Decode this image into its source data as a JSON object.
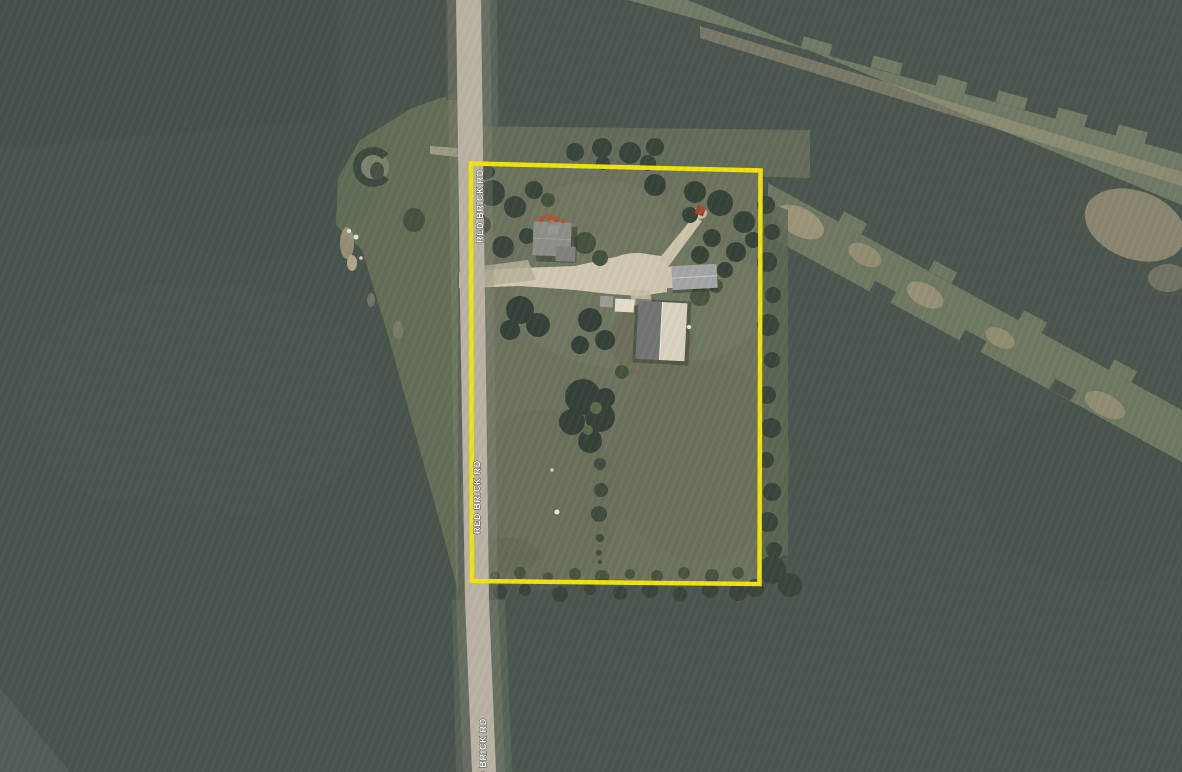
{
  "map": {
    "view": "aerial-imagery-parcel-view",
    "road": {
      "name": "RED BRICK RD",
      "labels": [
        "RED BRICK RD",
        "RED BRICK RD",
        "RED BRICK RD"
      ]
    },
    "parcel": {
      "boundary_color": "#f2e40c"
    },
    "colors": {
      "field_dark": "#4c5750",
      "field_west": "#4a554e",
      "parcel_grass": "#6e745f",
      "roadside_grass": "#657059",
      "waterway_light": "#717b66",
      "waterway_light2": "#6f7963",
      "bare_soil": "#a89c80",
      "road_pavement": "#bab3a6",
      "driveway": "#d2c9b2",
      "house_roof": "#8f8f8b",
      "shop_roof_dark": "#737676",
      "shop_roof_light": "#dad3c1",
      "garage_roof": "#a3a8a6",
      "tree_dark": "#3a463c",
      "label_text": "#ffffff"
    }
  }
}
